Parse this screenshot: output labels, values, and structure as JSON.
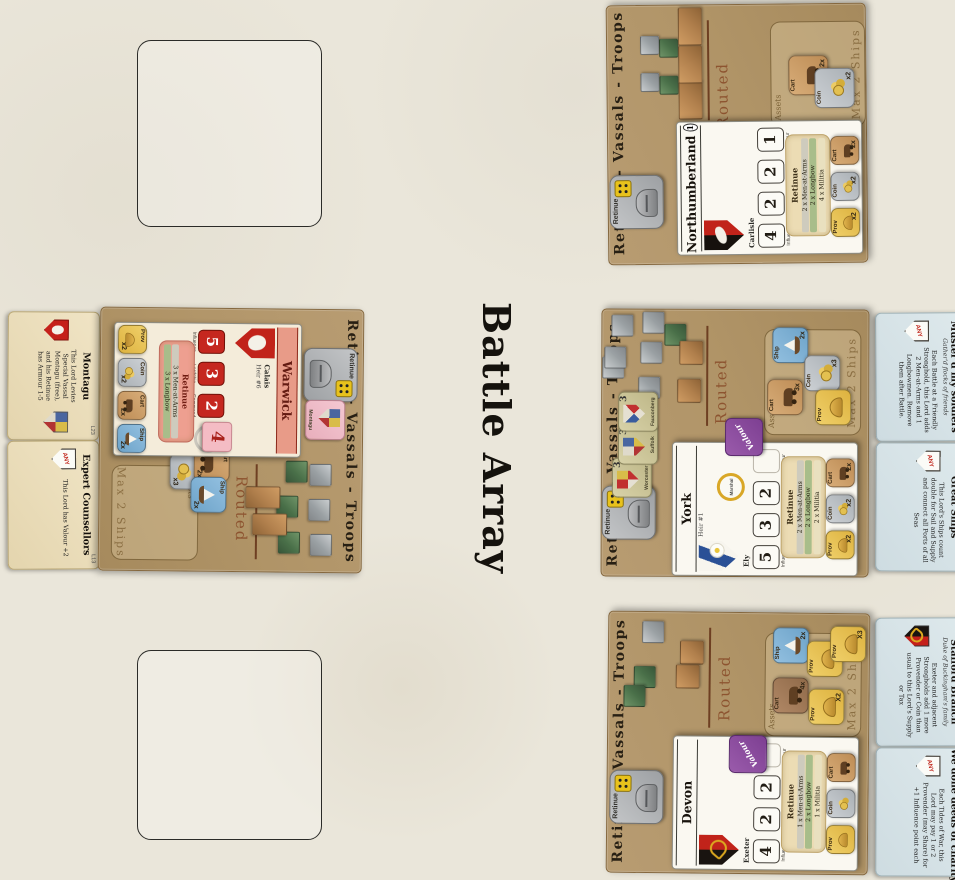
{
  "labels": {
    "any": "ANY"
  },
  "title": {
    "text": "Battle Array"
  },
  "mats": {
    "northumberland": {
      "header": "Retinue - Vassals - Troops",
      "routed_label": "Routed",
      "assets_label": "Assets",
      "max_ships_label": "Max 2 Ships",
      "retinue_token": {
        "label": "Retinue"
      },
      "blocks_summary": {
        "grey_cubes": 2,
        "green_cubes": 2,
        "brown_blocks": 3
      },
      "card": {
        "name": "Northumberland",
        "badge": "1",
        "seat": "Carlisle",
        "stats": [
          {
            "value": "4",
            "label": "Influence"
          },
          {
            "value": "2",
            "label": "Lordship"
          },
          {
            "value": "2",
            "label": "Command"
          },
          {
            "value": "1",
            "label": "Valour"
          }
        ],
        "retinue_title": "Retinue",
        "retinue_lines": [
          "2 x Men-at-Arms",
          "2 x Longbow",
          "4 x Militia"
        ],
        "assets": [
          {
            "name": "Prov",
            "mult": "x2"
          },
          {
            "name": "Coin",
            "mult": "x2"
          },
          {
            "name": "Cart",
            "mult": "2x"
          }
        ]
      },
      "mat_assets": [
        {
          "name": "Cart",
          "mult": "2x"
        },
        {
          "name": "Coin",
          "mult": "x2"
        }
      ]
    },
    "york": {
      "header": "Retinue - Vassals - Troops",
      "routed_label": "Routed",
      "assets_label": "Assets",
      "max_ships_label": "Max 2 Ships",
      "retinue_token": {
        "label": "Retinue"
      },
      "valour_token_label": "Valour",
      "special_ring": "Marshal",
      "blocks_summary": {
        "grey_cubes": 6,
        "green_cubes": 1,
        "brown_blocks": 2
      },
      "vassal_tokens": [
        {
          "name": "Worcester",
          "value": "3"
        },
        {
          "name": "Suffolk",
          "value": "3"
        },
        {
          "name": "Fauconberg",
          "value": "3"
        }
      ],
      "card": {
        "name": "York",
        "heir": "Heir #1",
        "seat": "Ely",
        "stats": [
          {
            "value": "5",
            "label": "Influence"
          },
          {
            "value": "3",
            "label": "Lordship"
          },
          {
            "value": "2",
            "label": "Command"
          }
        ],
        "valour_label": "Valour",
        "retinue_title": "Retinue",
        "retinue_lines": [
          "2 x Men-at-Arms",
          "2 x Longbow",
          "2 x Militia"
        ],
        "assets": [
          {
            "name": "Prov",
            "mult": "x2"
          },
          {
            "name": "Coin",
            "mult": "x2"
          },
          {
            "name": "Cart",
            "mult": "2x"
          }
        ]
      },
      "mat_assets": [
        {
          "name": "Ship",
          "mult": "2x"
        },
        {
          "name": "Coin",
          "mult": "x3"
        },
        {
          "name": "Cart",
          "mult": "3x"
        },
        {
          "name": "Prov",
          "mult": ""
        }
      ]
    },
    "devon": {
      "header": "Retinue - Vassals - Troops",
      "routed_label": "Routed",
      "assets_label": "Assets",
      "max_ships_label": "Max 2 Ships",
      "retinue_token": {
        "label": "Retinue"
      },
      "valour_token_label": "Valour",
      "blocks_summary": {
        "grey_cubes": 1,
        "green_cubes": 2,
        "brown_blocks": 2
      },
      "card": {
        "name": "Devon",
        "seat": "Exeter",
        "stats": [
          {
            "value": "4",
            "label": "Influence"
          },
          {
            "value": "2",
            "label": "Lordship"
          },
          {
            "value": "2",
            "label": "Command"
          }
        ],
        "valour_label": "Valour",
        "retinue_title": "Retinue",
        "retinue_lines": [
          "1 x Men-at-Arms",
          "2 x Longbow",
          "1 x Militia"
        ],
        "assets": [
          {
            "name": "Prov",
            "mult": ""
          },
          {
            "name": "Coin",
            "mult": ""
          },
          {
            "name": "Cart",
            "mult": ""
          }
        ]
      },
      "mat_assets": [
        {
          "name": "Ship",
          "mult": "2x"
        },
        {
          "name": "Prov",
          "mult": ""
        },
        {
          "name": "Prov",
          "mult": "X3"
        },
        {
          "name": "Cart",
          "mult": "4x"
        },
        {
          "name": "Prov",
          "mult": "X2"
        }
      ]
    },
    "warwick": {
      "header": "Retinue - Vassals - Troops",
      "routed_label": "Routed",
      "assets_label": "Assets",
      "max_ships_label": "Max 2 Ships",
      "retinue_token": {
        "label": "Retinue"
      },
      "montagu_token": {
        "name": "Montagu"
      },
      "special_ring": "Lieutenant",
      "valour_value_token": "4",
      "blocks_summary": {
        "grey_cubes": 3,
        "green_cubes": 3,
        "brown_blocks": 2
      },
      "card": {
        "name": "Warwick",
        "heir": "Heir #6",
        "seat": "Calais",
        "stats": [
          {
            "value": "5",
            "label": "Influence"
          },
          {
            "value": "3",
            "label": "Lordship"
          },
          {
            "value": "2",
            "label": "Command"
          }
        ],
        "retinue_title": "Retinue",
        "retinue_lines": [
          "3 x Men-at-Arms",
          "3 x Longbow"
        ],
        "assets": [
          {
            "name": "Prov",
            "mult": "x2"
          },
          {
            "name": "Coin",
            "mult": "x2"
          },
          {
            "name": "Cart",
            "mult": "2x"
          },
          {
            "name": "Ship",
            "mult": "2x"
          }
        ]
      },
      "mat_assets": [
        {
          "name": "Coin",
          "mult": "x3"
        },
        {
          "name": "Cart",
          "mult": "2x"
        },
        {
          "name": "Ship",
          "mult": "2x"
        }
      ]
    }
  },
  "event_cards": {
    "left": [
      {
        "id": "L23",
        "title": "Montagu",
        "body": "This Lord Levies Special Vassal Montagu (free), and his Retinue has Armour 1-5"
      },
      {
        "id": "L13",
        "title": "Expert Counsellors",
        "body": "This Lord has Valour +2"
      }
    ],
    "right": [
      {
        "id": "Y3",
        "title": "Muster'd my soldiers",
        "subtitle": "Gather'd flocks of friends",
        "body": "Each Battle at a Friendly Stronghold, this Lord adds 2 Men-at-Arms and 1 Longbowmen. Remove them after Battle."
      },
      {
        "id": "Y6",
        "title": "Great Ships",
        "body": "This Lord's Ships count double for Sail and Supply and connect all Ports of all Seas"
      },
      {
        "id": "Y29",
        "title": "Stafford Branch",
        "subtitle": "Duke of Buckingham's family",
        "body": "Exeter and adjacent Strongholds add 1 more Provender or Coin than usual to this Lord's Supply or Tax"
      },
      {
        "id": "Y4",
        "title": "We done deeds of charity",
        "body": "Each Tides of War, this Lord may pay 1 or 2 Provender (may Share) for +1 Influence point each"
      }
    ]
  }
}
